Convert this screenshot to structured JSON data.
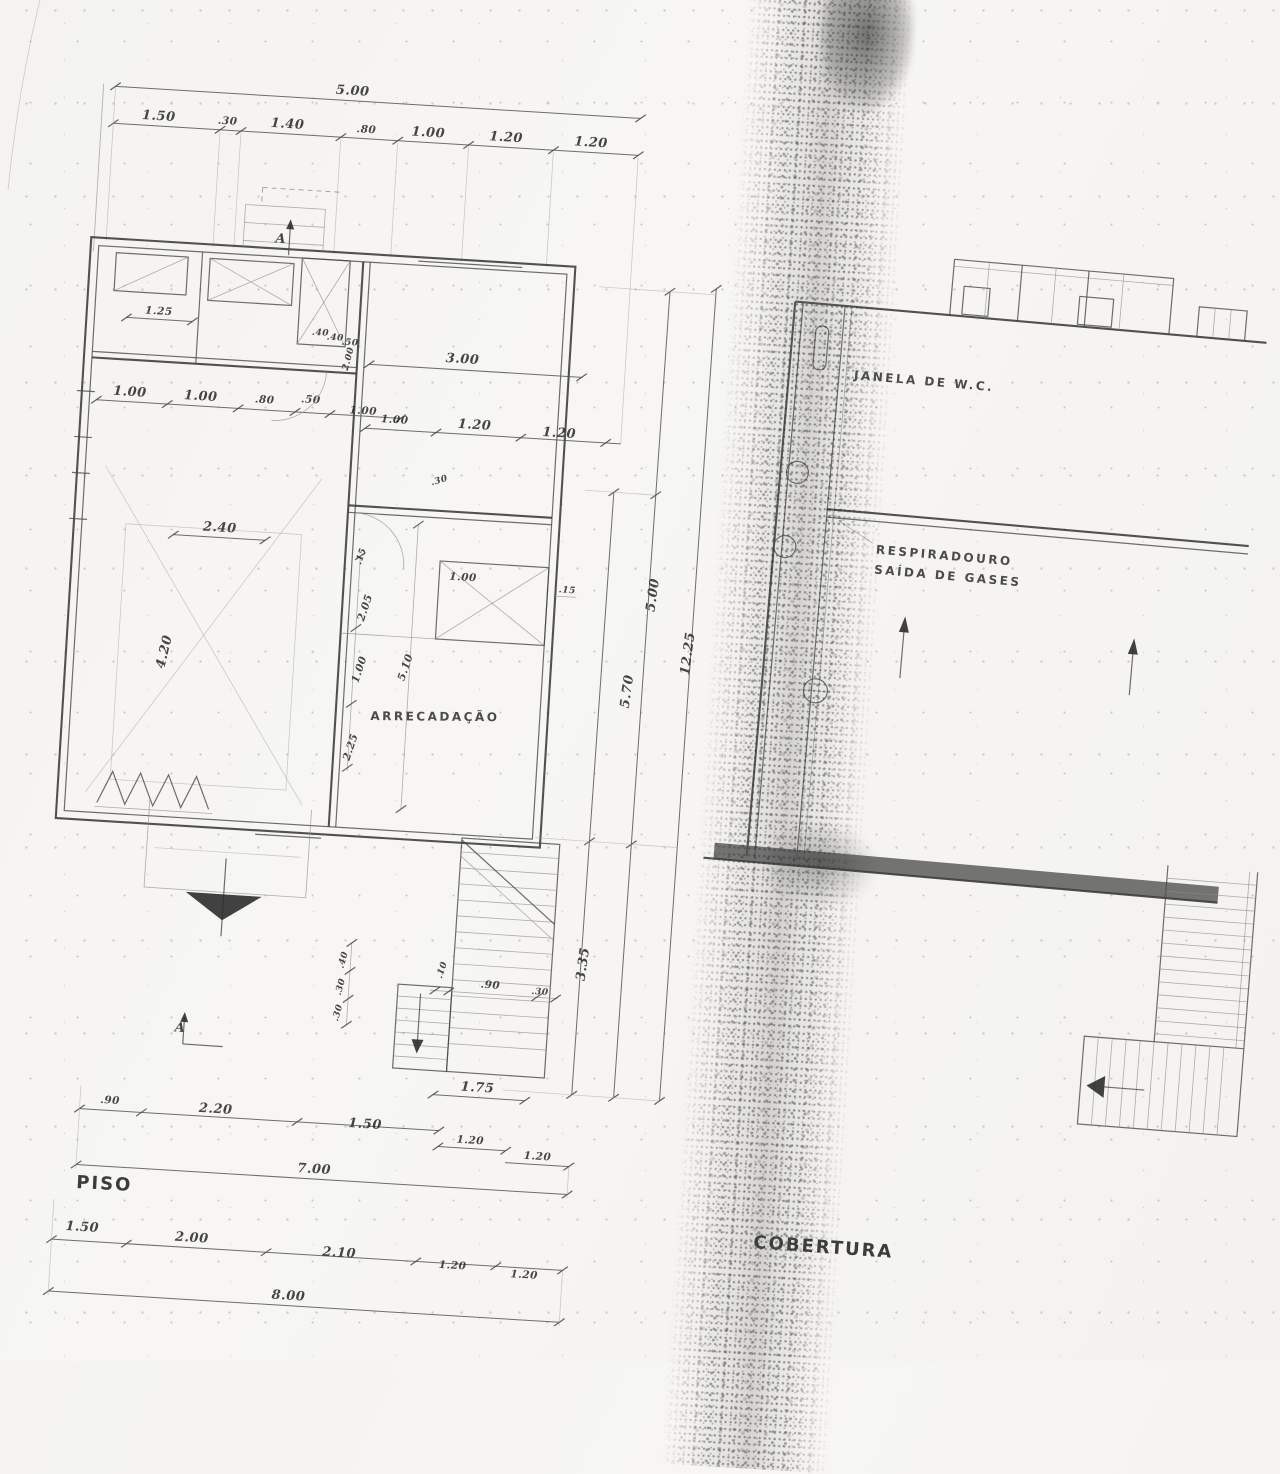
{
  "scan": {
    "paper_color": "#f6f5f1",
    "ink_color": "#3a3a3a"
  },
  "drawing": {
    "piso": {
      "title": "PISO",
      "room_label": "ARRECADAÇÃO",
      "section_marker": "A",
      "dims": {
        "top_total": "5.00",
        "top_chain": [
          "1.50",
          ".30",
          "1.40",
          ".80",
          "1.00",
          "1.20",
          "1.20"
        ],
        "left_chain": [
          "1.25",
          "1.00",
          "1.00",
          ".80",
          ".50",
          "1.00"
        ],
        "room_top": "3.00",
        "room_chain": [
          "1.00",
          "1.20",
          "1.20"
        ],
        "interior": {
          "w240": "2.40",
          "h420": "4.20",
          "t15a": ".15",
          "w205": "2.05",
          "h100": "1.00",
          "h510": "5.10",
          "h225": "2.25",
          "b100": "1.00",
          "t15b": ".15",
          "t30": ".30",
          "t200": "2.00",
          "q40a": ".40",
          "q40b": ".40",
          "q50": ".50"
        },
        "right_vertical": {
          "v500": "5.00",
          "v1225": "12.25",
          "v570": "5.70",
          "v335": "3.35"
        },
        "stair": {
          "s10": ".10",
          "s90": ".90",
          "s30": ".30",
          "s175": "1.75",
          "s40": ".40",
          "sv30a": ".30",
          "sv30b": ".30"
        },
        "bottom_chain1": [
          ".90",
          "2.20",
          "1.50",
          "1.20",
          "1.20"
        ],
        "bottom_total1": "7.00",
        "bottom_chain2": [
          "1.50",
          "2.00",
          "2.10",
          "1.20",
          "1.20"
        ],
        "bottom_total2": "8.00"
      }
    },
    "cobertura": {
      "title": "COBERTURA",
      "wc_label": "JANELA DE W.C.",
      "vent_line1": "RESPIRADOURO",
      "vent_line2": "SAÍDA DE GASES"
    }
  }
}
